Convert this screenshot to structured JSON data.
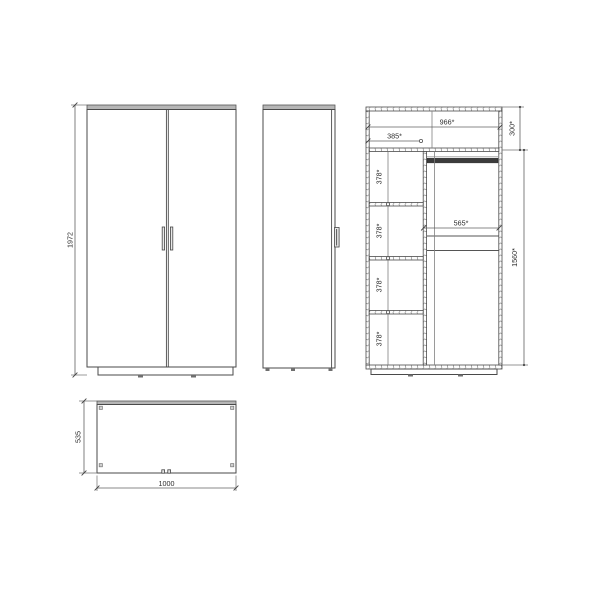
{
  "drawing": {
    "front": {
      "height": "1972"
    },
    "internal": {
      "top_width": "966*",
      "left_col_width": "385*",
      "top_height": "300*",
      "cell_height": "378*",
      "right_width": "565*",
      "right_height": "1560*"
    },
    "plan": {
      "depth": "535",
      "width": "1000"
    }
  },
  "colors": {
    "line": "#4a4a4a",
    "panel_fill": "#b6b6b6",
    "rod": "#3c3c3c",
    "background": "#ffffff"
  }
}
